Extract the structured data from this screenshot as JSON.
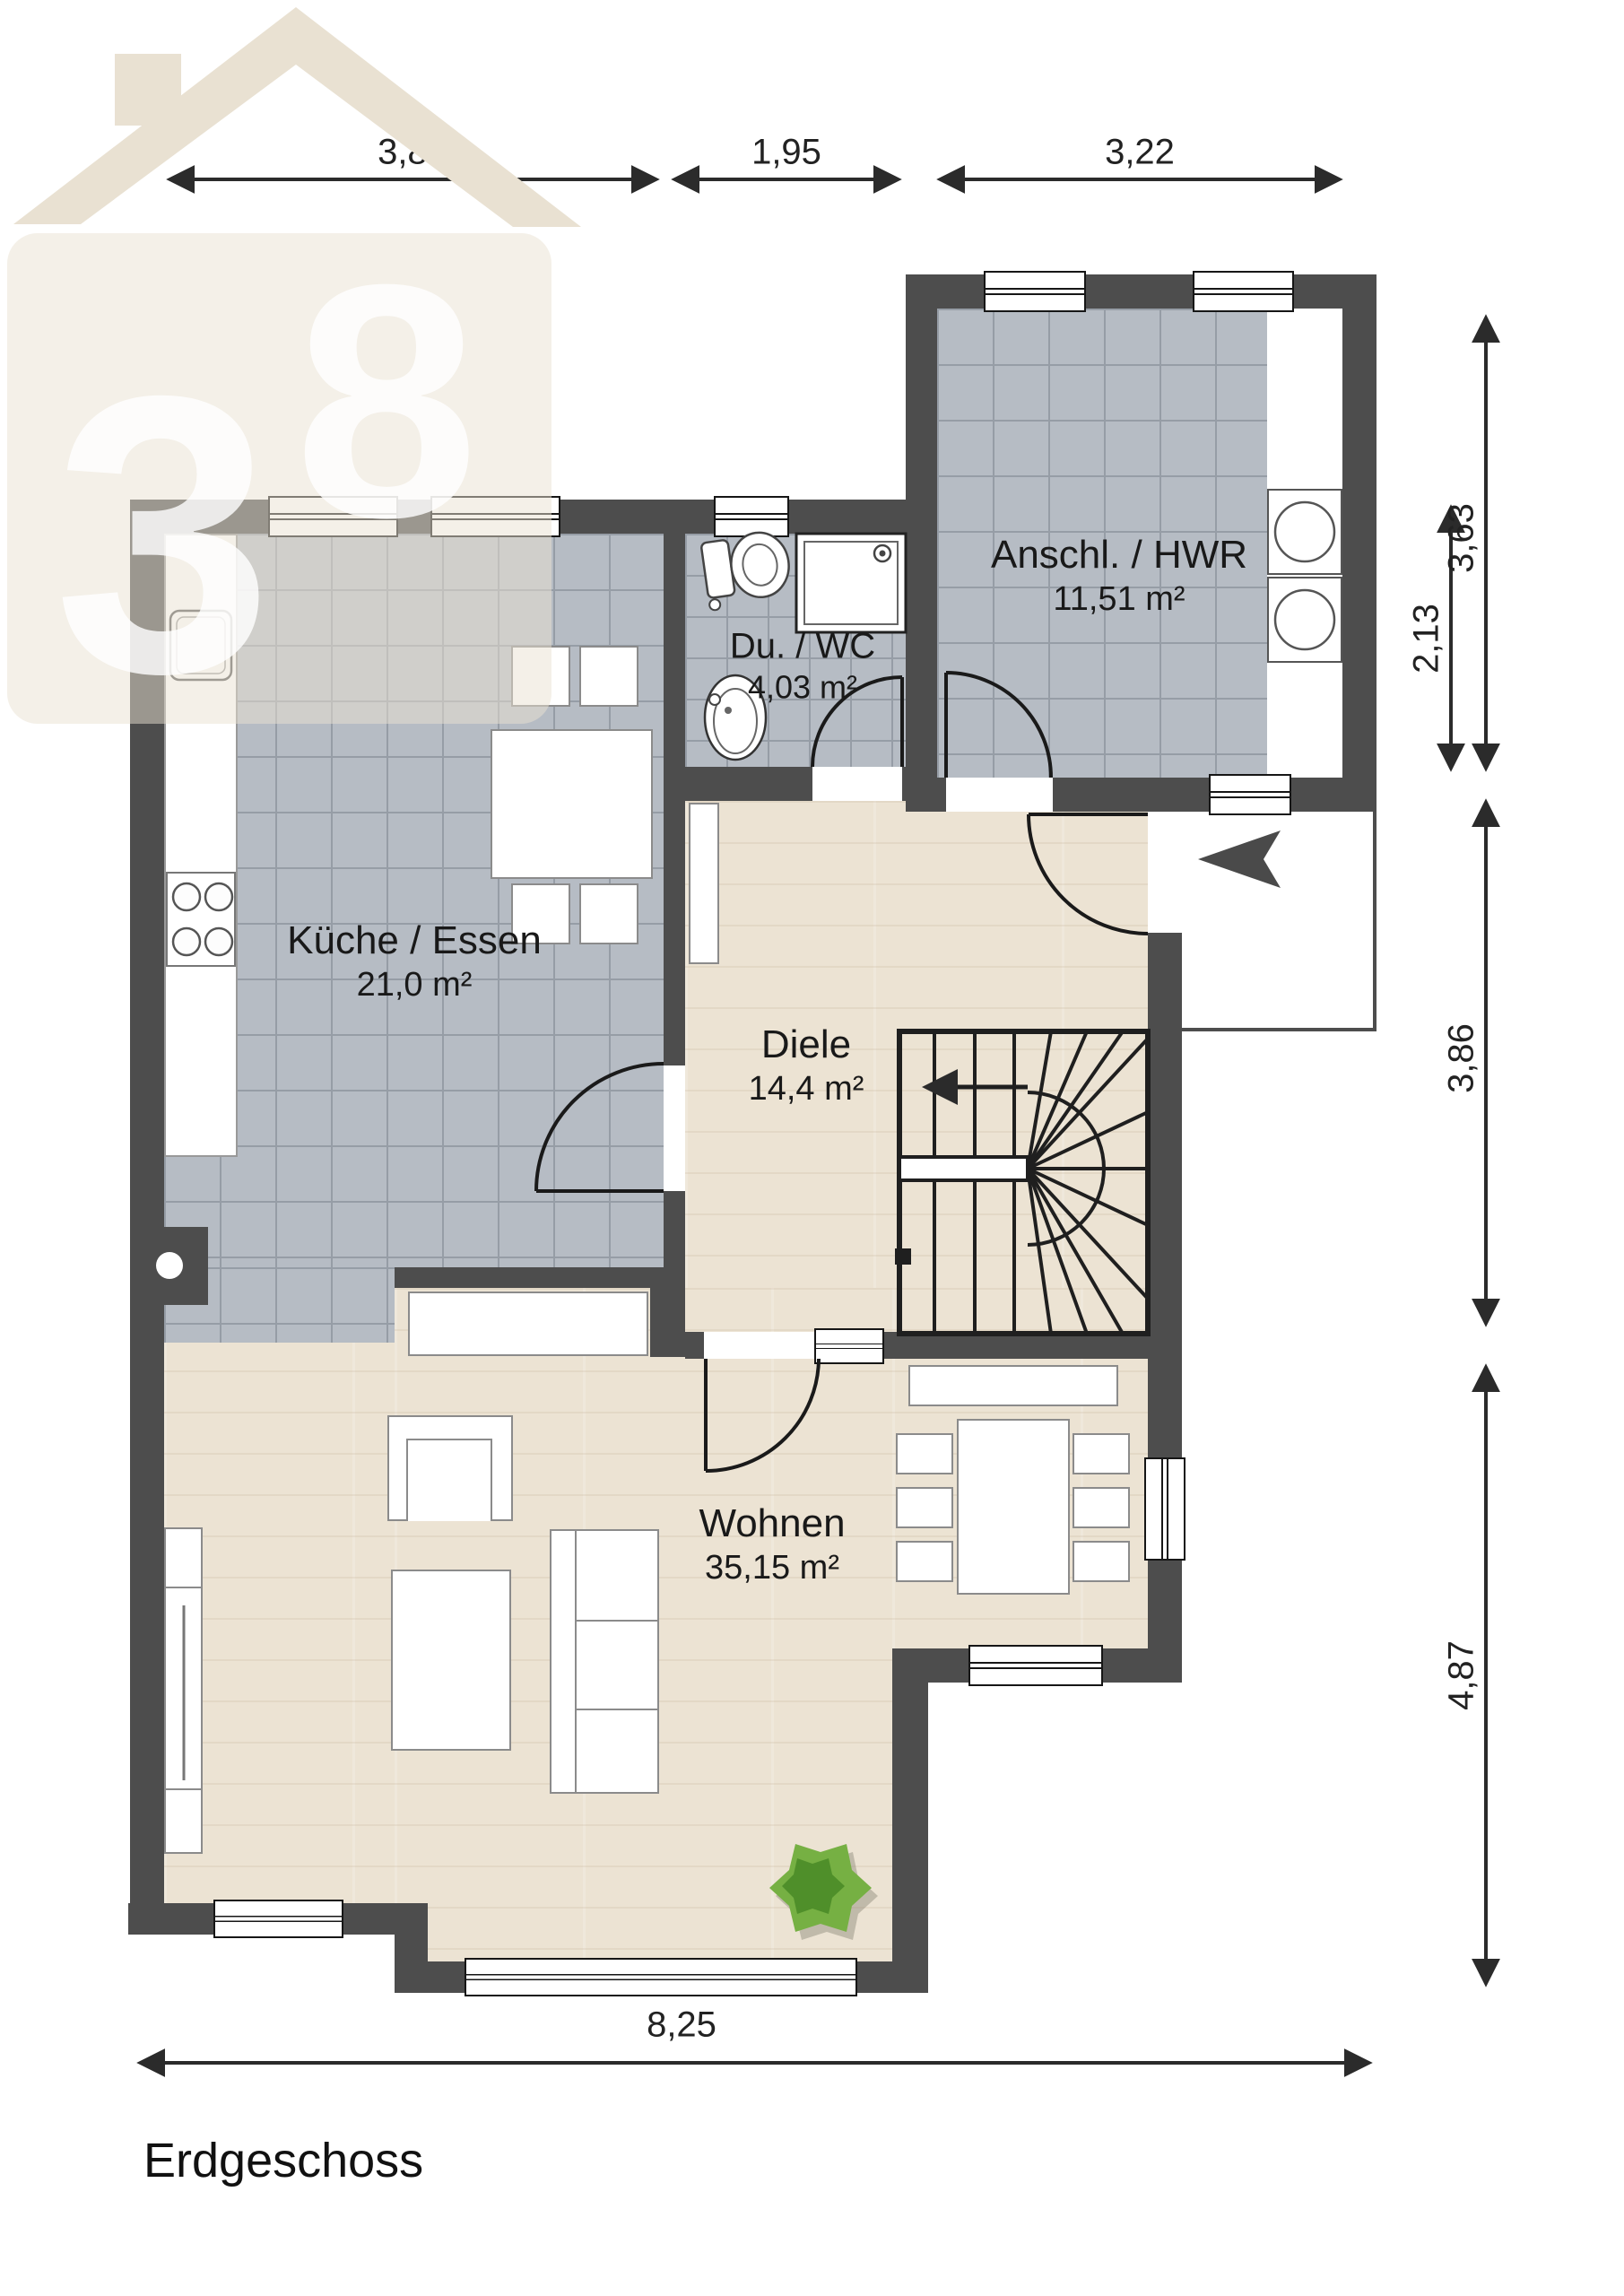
{
  "title": "Erdgeschoss",
  "watermark": {
    "digits": [
      "3",
      "8"
    ]
  },
  "rooms": [
    {
      "name": "Küche / Essen",
      "area": "21,0 m²"
    },
    {
      "name": "Du. / WC",
      "area": "4,03 m²"
    },
    {
      "name": "Anschl. / HWR",
      "area": "11,51 m²"
    },
    {
      "name": "Diele",
      "area": "14,4 m²"
    },
    {
      "name": "Wohnen",
      "area": "35,15 m²"
    }
  ],
  "dimensions": {
    "top": [
      "3,81",
      "1,95",
      "3,22"
    ],
    "right": [
      "3,63",
      "2,13",
      "3,86",
      "4,87"
    ],
    "bottom": [
      "8,25"
    ]
  }
}
